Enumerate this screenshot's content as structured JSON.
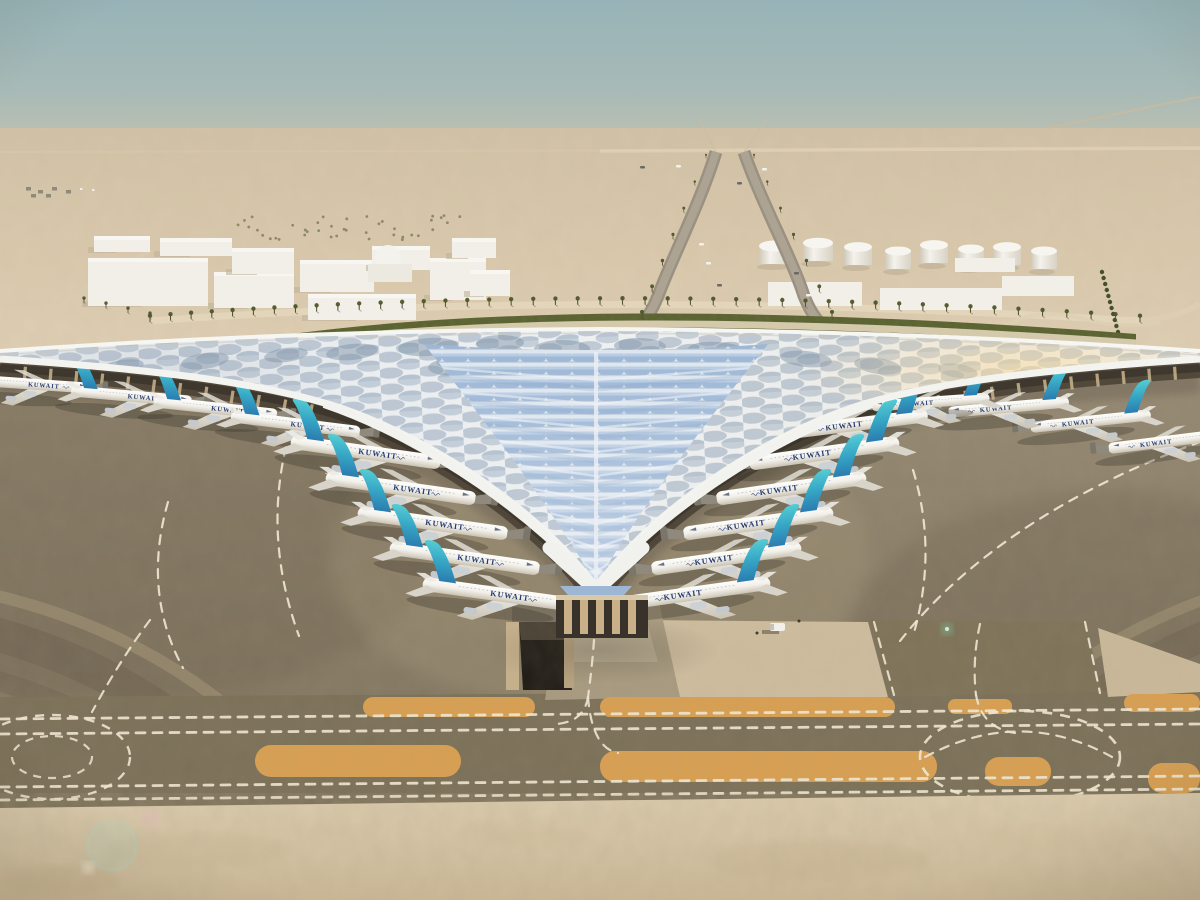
{
  "scene": {
    "visible_text": [
      "KUWAIT"
    ]
  },
  "aircraft": {
    "livery_label": "KUWAIT",
    "label_color": "#243a72",
    "tail_top": "#55ccd4",
    "tail_bottom": "#2b7cb0",
    "fuselage": "#f2f0ea",
    "count_total": 19,
    "count_left_concourse": 9,
    "count_right_concourse": 10
  },
  "palette": {
    "sky_top": "#97b3b7",
    "sky_horizon": "#dbcdb3",
    "desert_sand": "#dac9ad",
    "foreground_sand": "#d3c2a3",
    "apron_concrete": "#8d816c",
    "taxiway": "#7b7058",
    "sand_strip": "#d79f52",
    "road_marking": "#efe8d4",
    "roof_white": "#eceff1",
    "roof_glazing": "#9db7d6",
    "hedge_green": "#5a6130",
    "tank_white": "#f4f2ec"
  },
  "background": {
    "fuel_tank_count": 8
  }
}
